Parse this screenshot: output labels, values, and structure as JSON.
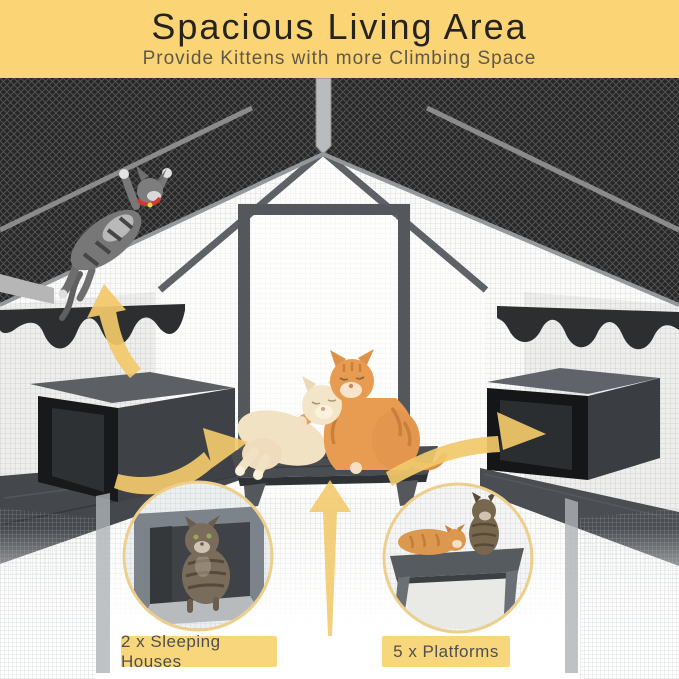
{
  "banner": {
    "title": "Spacious Living Area",
    "subtitle": "Provide Kittens with more Climbing Space",
    "bg_color": "#FAD475",
    "title_color": "#26231D",
    "subtitle_color": "#5E5849"
  },
  "callouts": {
    "sleeping_houses": {
      "label": "2 x Sleeping Houses"
    },
    "platforms": {
      "label": "5 x Platforms"
    },
    "bg_color": "#F8D67C",
    "text_color": "#4F4F4F"
  },
  "accents": {
    "arrow_color": "#F3C96B",
    "inset_ring_color": "#ECCF8C",
    "roof_color": "#272727",
    "wood_gray": "#4A4E52"
  }
}
